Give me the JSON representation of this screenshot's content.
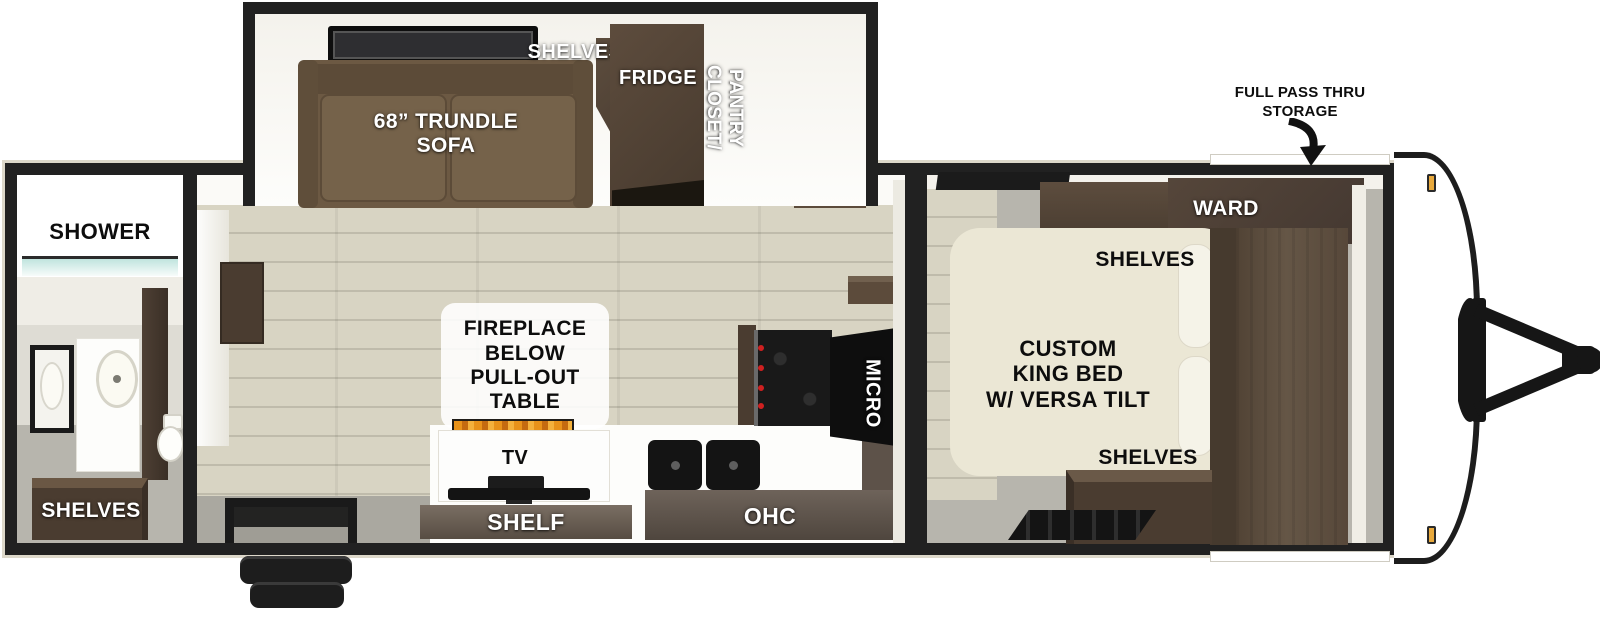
{
  "labels": {
    "storage": "FULL PASS THRU\nSTORAGE",
    "shower": "SHOWER",
    "bath_shelves": "SHELVES",
    "sofa": "68” TRUNDLE\nSOFA",
    "kitchen_shelves": "SHELVES",
    "fridge": "FRIDGE",
    "closet_pantry": "CLOSET/\nPANTRY",
    "fireplace": "FIREPLACE\nBELOW\nPULL-OUT TABLE",
    "tv": "TV",
    "shelf": "SHELF",
    "ohc": "OHC",
    "micro": "MICRO",
    "bed": "CUSTOM\nKING BED\nW/ VERSA TILT",
    "ward": "WARD",
    "bed_shelves_top": "SHELVES",
    "bed_shelves_bottom": "SHELVES"
  },
  "colors": {
    "wall": "#212121",
    "trim": "#ddd8ca",
    "wood_floor": "#d8d4c3",
    "plank_line": "#bfbbab",
    "floor_gray": "#b7b5ad",
    "sofa": "#6c5943",
    "sofa_dark": "#5c4b38",
    "cabinet_dark": "#4a3c30",
    "cabinet_mid": "#5d4d3e",
    "bed": "#ebe7d5",
    "flame": "#e8921a",
    "amber": "#e8a93c"
  }
}
